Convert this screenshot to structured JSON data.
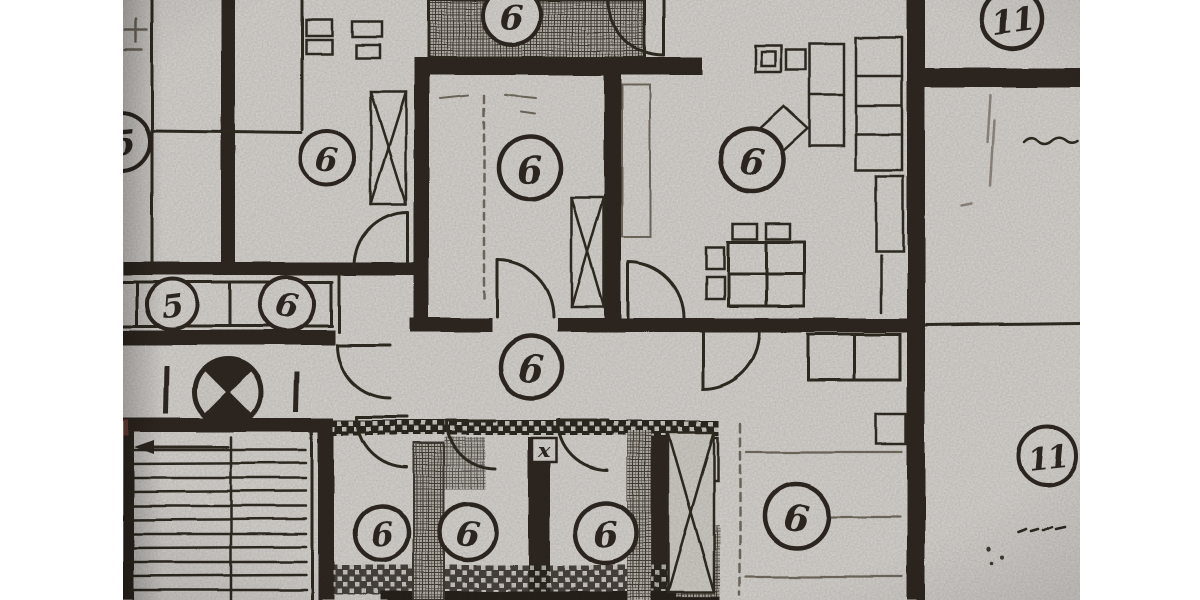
{
  "document": {
    "kind_label": "floor-plan-photo"
  },
  "colors": {
    "page_background": "#ffffff",
    "paper": "#d7d4d0",
    "ink": "#2a261f",
    "ink_faint": "#6f675c",
    "red_speck": "#7b4036"
  },
  "plan": {
    "room_labels": [
      {
        "name": "edge-room-label-left",
        "value": "5"
      },
      {
        "name": "room-label-left",
        "value": "6"
      },
      {
        "name": "room-label-top-hatch",
        "value": "6"
      },
      {
        "name": "room-label-center",
        "value": "6"
      },
      {
        "name": "room-label-right",
        "value": "6"
      },
      {
        "name": "room-label-top-right",
        "value": "11"
      },
      {
        "name": "box-label-left",
        "value": "5"
      },
      {
        "name": "box-label-right",
        "value": "6"
      },
      {
        "name": "corridor-label",
        "value": "6"
      },
      {
        "name": "bath-label-1",
        "value": "6"
      },
      {
        "name": "bath-label-2",
        "value": "6"
      },
      {
        "name": "bath-label-3",
        "value": "6"
      },
      {
        "name": "room-label-bottom-right",
        "value": "6"
      },
      {
        "name": "room-label-right-unit",
        "value": "11"
      }
    ],
    "shaft_marker": {
      "name": "shaft-x-marker",
      "value": "x"
    },
    "symbols": [
      "survey-marker-icon",
      "stairs-arrow-icon",
      "door-swing-arc",
      "crosshatch-wall",
      "x-braced-shaft"
    ]
  }
}
